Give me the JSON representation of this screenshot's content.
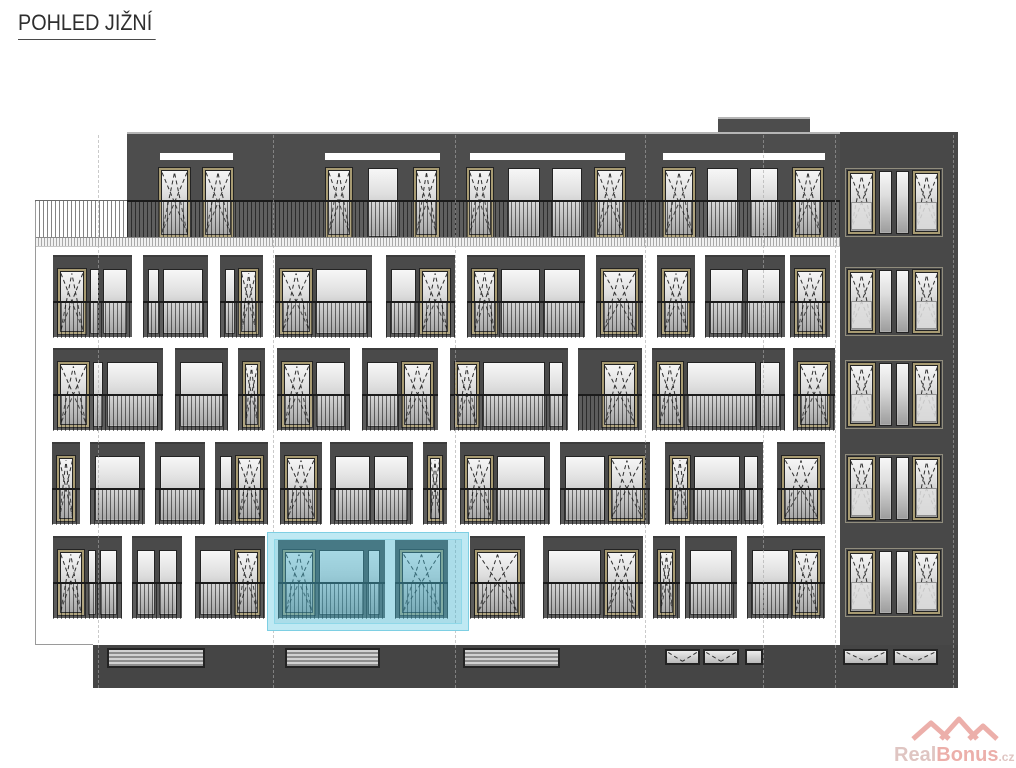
{
  "title": {
    "text": "POHLED JIŽNÍ"
  },
  "watermark": {
    "real": "Real",
    "bonus": "Bonus",
    "tld": ".cz"
  },
  "colors": {
    "facade": "#4d4d4d",
    "bay": "#4a4a4a",
    "ground": "#454545",
    "tower": "#484848",
    "frame_dark": "#232323",
    "frame_beige": "#a89b72",
    "glass_top": "#f7f7f7",
    "glass_bottom": "#9c9c9c",
    "highlight_border": "#bfe9f3",
    "highlight_fill": "rgba(69,180,207,0.45)",
    "roof_edge": "#b5b5b5",
    "axis": "#a8a8a8",
    "watermark_pink": "#e2857d",
    "watermark_gray": "#cfa7a2"
  },
  "drawing": {
    "canvas": {
      "w": 1016,
      "h": 768
    },
    "blocks": [
      {
        "name": "roof-box",
        "x": 718,
        "y": 117,
        "w": 92,
        "h": 17,
        "color": "facade",
        "edge": true
      },
      {
        "name": "top-floor-band",
        "x": 127,
        "y": 132,
        "w": 831,
        "h": 111,
        "color": "facade",
        "edge": true
      },
      {
        "name": "right-tower",
        "x": 840,
        "y": 132,
        "w": 118,
        "h": 556,
        "color": "tower",
        "edge": false
      },
      {
        "name": "ground-plinth",
        "x": 93,
        "y": 645,
        "w": 865,
        "h": 43,
        "color": "ground",
        "edge": false
      }
    ],
    "slots": {
      "y": 153,
      "h": 7,
      "items": [
        {
          "x": 160,
          "w": 73
        },
        {
          "x": 325,
          "w": 115
        },
        {
          "x": 470,
          "w": 155
        },
        {
          "x": 663,
          "w": 162
        }
      ]
    },
    "top_windows": {
      "y": 168,
      "h": 69,
      "items": [
        {
          "x": 159,
          "w": 31,
          "t": "D"
        },
        {
          "x": 203,
          "w": 30,
          "t": "D"
        },
        {
          "x": 326,
          "w": 26,
          "t": "D"
        },
        {
          "x": 368,
          "w": 30,
          "t": "W"
        },
        {
          "x": 414,
          "w": 25,
          "t": "D"
        },
        {
          "x": 467,
          "w": 26,
          "t": "D"
        },
        {
          "x": 508,
          "w": 32,
          "t": "W"
        },
        {
          "x": 552,
          "w": 30,
          "t": "W"
        },
        {
          "x": 595,
          "w": 30,
          "t": "D"
        },
        {
          "x": 663,
          "w": 32,
          "t": "D"
        },
        {
          "x": 707,
          "w": 31,
          "t": "W"
        },
        {
          "x": 750,
          "w": 28,
          "t": "W"
        },
        {
          "x": 793,
          "w": 30,
          "t": "D"
        }
      ]
    },
    "terrace_railing": {
      "x": 35,
      "split": 127,
      "end": 840,
      "y": 200,
      "h": 37,
      "base_y": 237,
      "base_h": 8
    },
    "rows": [
      {
        "y": 255,
        "h": 82,
        "bays": [
          {
            "x": 53,
            "w": 79,
            "panes": [
              {
                "t": "D",
                "f": 30
              },
              {
                "t": "N",
                "f": 9
              },
              {
                "t": "W",
                "f": 28
              }
            ]
          },
          {
            "x": 143,
            "w": 65,
            "panes": [
              {
                "t": "N",
                "f": 12
              },
              {
                "t": "W",
                "f": 48
              }
            ]
          },
          {
            "x": 220,
            "w": 43,
            "panes": [
              {
                "t": "W",
                "f": 13
              },
              {
                "t": "D",
                "f": 26
              }
            ]
          },
          {
            "x": 275,
            "w": 97,
            "panes": [
              {
                "t": "D",
                "f": 30
              },
              {
                "t": "W",
                "f": 52
              }
            ]
          },
          {
            "x": 386,
            "w": 69,
            "panes": [
              {
                "t": "W",
                "f": 26
              },
              {
                "t": "D",
                "f": 30
              }
            ]
          },
          {
            "x": 467,
            "w": 118,
            "panes": [
              {
                "t": "D",
                "f": 22
              },
              {
                "t": "W",
                "f": 38
              },
              {
                "t": "W",
                "f": 36
              }
            ]
          },
          {
            "x": 596,
            "w": 47,
            "panes": [
              {
                "t": "D",
                "f": 32
              }
            ]
          },
          {
            "x": 657,
            "w": 38,
            "panes": [
              {
                "t": "D",
                "f": 28
              }
            ]
          },
          {
            "x": 705,
            "w": 80,
            "panes": [
              {
                "t": "W",
                "f": 33
              },
              {
                "t": "W",
                "f": 33
              }
            ]
          },
          {
            "x": 790,
            "w": 40,
            "panes": [
              {
                "t": "D",
                "f": 27
              }
            ]
          }
        ]
      },
      {
        "y": 348,
        "h": 82,
        "bays": [
          {
            "x": 53,
            "w": 110,
            "panes": [
              {
                "t": "D",
                "f": 30
              },
              {
                "t": "N",
                "f": 9
              },
              {
                "t": "W",
                "f": 55
              }
            ]
          },
          {
            "x": 175,
            "w": 53,
            "panes": [
              {
                "t": "W",
                "f": 46
              }
            ]
          },
          {
            "x": 238,
            "w": 27,
            "panes": [
              {
                "t": "D",
                "f": 22
              }
            ]
          },
          {
            "x": 277,
            "w": 73,
            "panes": [
              {
                "t": "D",
                "f": 30
              },
              {
                "t": "W",
                "f": 32
              }
            ]
          },
          {
            "x": 362,
            "w": 76,
            "panes": [
              {
                "t": "W",
                "f": 32
              },
              {
                "t": "D",
                "f": 30
              }
            ]
          },
          {
            "x": 450,
            "w": 118,
            "panes": [
              {
                "t": "D",
                "f": 20
              },
              {
                "t": "W",
                "f": 62
              },
              {
                "t": "N",
                "f": 12
              }
            ]
          },
          {
            "x": 578,
            "w": 64,
            "panes": [
              {
                "t": "S",
                "f": 14
              },
              {
                "t": "D",
                "f": 30
              }
            ]
          },
          {
            "x": 652,
            "w": 133,
            "panes": [
              {
                "t": "Dn",
                "f": 16
              },
              {
                "t": "W",
                "f": 50
              },
              {
                "t": "N",
                "f": 13
              }
            ]
          },
          {
            "x": 793,
            "w": 42,
            "panes": [
              {
                "t": "D",
                "f": 28
              }
            ]
          }
        ]
      },
      {
        "y": 442,
        "h": 82,
        "bays": [
          {
            "x": 52,
            "w": 28,
            "panes": [
              {
                "t": "D",
                "f": 24
              }
            ]
          },
          {
            "x": 90,
            "w": 55,
            "panes": [
              {
                "t": "W",
                "f": 48
              }
            ]
          },
          {
            "x": 155,
            "w": 50,
            "panes": [
              {
                "t": "W",
                "f": 44
              }
            ]
          },
          {
            "x": 215,
            "w": 53,
            "panes": [
              {
                "t": "W",
                "f": 13
              },
              {
                "t": "D",
                "f": 30
              }
            ]
          },
          {
            "x": 280,
            "w": 42,
            "panes": [
              {
                "t": "D",
                "f": 28
              }
            ]
          },
          {
            "x": 330,
            "w": 83,
            "panes": [
              {
                "t": "W",
                "f": 35
              },
              {
                "t": "W",
                "f": 35
              }
            ]
          },
          {
            "x": 423,
            "w": 24,
            "panes": [
              {
                "t": "D",
                "f": 20
              }
            ]
          },
          {
            "x": 460,
            "w": 90,
            "panes": [
              {
                "t": "D",
                "f": 24
              },
              {
                "t": "W",
                "f": 45
              }
            ]
          },
          {
            "x": 560,
            "w": 90,
            "panes": [
              {
                "t": "W",
                "f": 36
              },
              {
                "t": "D",
                "f": 30
              }
            ]
          },
          {
            "x": 665,
            "w": 98,
            "panes": [
              {
                "t": "Dn",
                "f": 18
              },
              {
                "t": "W",
                "f": 50
              },
              {
                "t": "N",
                "f": 14
              }
            ]
          },
          {
            "x": 777,
            "w": 48,
            "panes": [
              {
                "t": "D",
                "f": 30
              }
            ]
          }
        ]
      },
      {
        "y": 536,
        "h": 82,
        "bays": [
          {
            "x": 53,
            "w": 69,
            "panes": [
              {
                "t": "D",
                "f": 28
              },
              {
                "t": "N",
                "f": 8
              },
              {
                "t": "W",
                "f": 20
              }
            ]
          },
          {
            "x": 132,
            "w": 50,
            "panes": [
              {
                "t": "W",
                "f": 20
              },
              {
                "t": "W",
                "f": 20
              }
            ]
          },
          {
            "x": 195,
            "w": 70,
            "panes": [
              {
                "t": "W",
                "f": 36
              },
              {
                "t": "D",
                "f": 27
              }
            ]
          },
          {
            "x": 278,
            "w": 107,
            "panes": [
              {
                "t": "D",
                "f": 30
              },
              {
                "t": "W",
                "f": 46
              },
              {
                "t": "N",
                "f": 11
              }
            ]
          },
          {
            "x": 395,
            "w": 53,
            "panes": [
              {
                "t": "D",
                "f": 28
              }
            ]
          },
          {
            "x": 470,
            "w": 55,
            "panes": [
              {
                "t": "D",
                "f": 24
              }
            ]
          },
          {
            "x": 543,
            "w": 100,
            "panes": [
              {
                "t": "W",
                "f": 50
              },
              {
                "t": "D",
                "f": 28
              }
            ]
          },
          {
            "x": 653,
            "w": 27,
            "panes": [
              {
                "t": "Dn",
                "f": 13
              }
            ]
          },
          {
            "x": 685,
            "w": 52,
            "panes": [
              {
                "t": "W",
                "f": 46
              }
            ]
          },
          {
            "x": 747,
            "w": 78,
            "panes": [
              {
                "t": "W",
                "f": 42
              },
              {
                "t": "D",
                "f": 27
              }
            ]
          }
        ]
      }
    ],
    "tower_groups": {
      "x": 845,
      "w": 98,
      "h": 69,
      "ys": [
        168,
        267,
        360,
        454,
        548
      ],
      "panes": [
        {
          "t": "DG",
          "f": 28
        },
        {
          "t": "N",
          "f": 13
        },
        {
          "t": "N",
          "f": 13
        },
        {
          "t": "DG",
          "f": 28
        }
      ]
    },
    "ground": {
      "vents": {
        "y": 648,
        "h": 20,
        "items": [
          {
            "x": 107,
            "w": 98
          },
          {
            "x": 285,
            "w": 95
          },
          {
            "x": 463,
            "w": 97
          }
        ]
      },
      "hoppers": {
        "y": 649,
        "h": 16,
        "items": [
          {
            "x": 665,
            "w": 35
          },
          {
            "x": 703,
            "w": 36
          },
          {
            "x": 843,
            "w": 45
          },
          {
            "x": 893,
            "w": 45
          }
        ]
      },
      "square": {
        "x": 745,
        "y": 649,
        "w": 18,
        "h": 16
      }
    },
    "axes": {
      "y": 135,
      "h": 553,
      "xs": [
        98,
        273,
        455,
        645,
        763,
        835,
        953
      ]
    },
    "edge_lines": [
      {
        "x": 35,
        "y": 202,
        "w": 1,
        "h": 443
      },
      {
        "x": 35,
        "y": 644,
        "w": 58,
        "h": 1
      }
    ],
    "highlight": {
      "x": 268,
      "y": 533,
      "w": 200,
      "h": 97
    }
  }
}
